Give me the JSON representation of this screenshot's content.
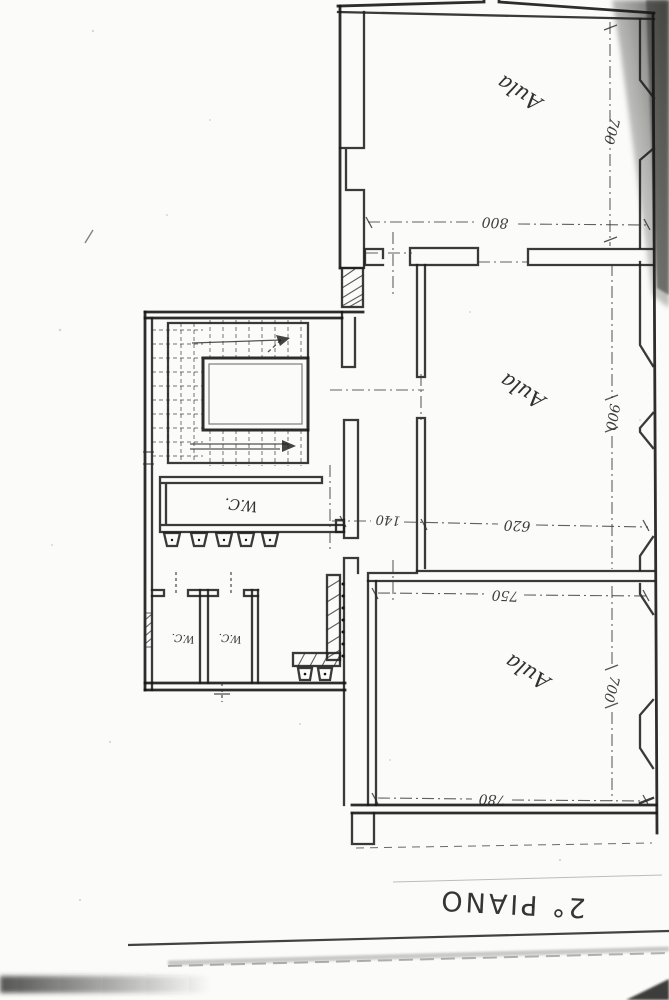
{
  "document": {
    "floor_title": "2° PIANO"
  },
  "rooms": {
    "aula_top": {
      "label": "Aula"
    },
    "aula_middle": {
      "label": "Aula"
    },
    "aula_bottom": {
      "label": "Aula"
    },
    "wc_main": {
      "label": "W.C."
    },
    "wc_cubicle_left": {
      "label": "W.C."
    },
    "wc_cubicle_right": {
      "label": "W.C."
    }
  },
  "dimensions": {
    "aula_top": {
      "depth": "700",
      "width": "800"
    },
    "aula_middle": {
      "depth": "900",
      "width": "620"
    },
    "corridor": {
      "width": "140"
    },
    "aula_bottom": {
      "width_top": "750",
      "depth": "700",
      "width_bottom": "780"
    }
  }
}
